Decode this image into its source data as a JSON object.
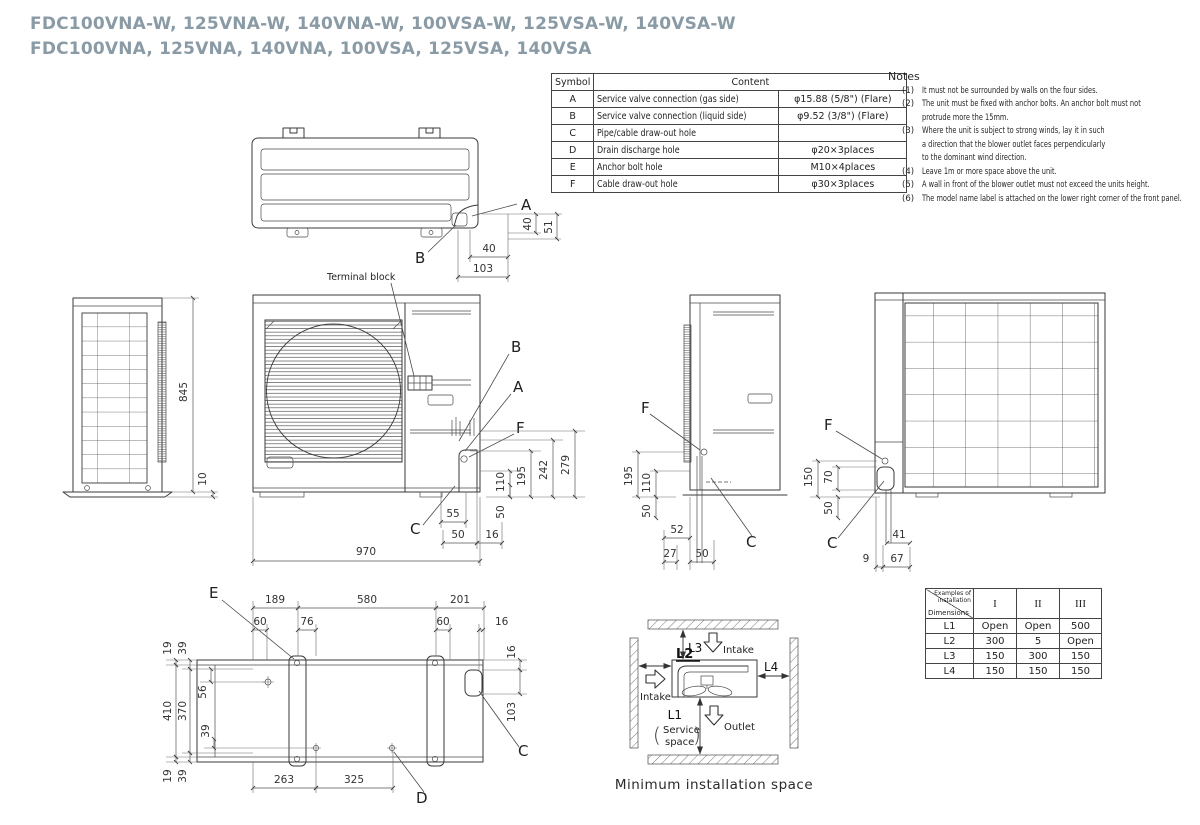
{
  "title": {
    "line1": "FDC100VNA-W, 125VNA-W, 140VNA-W, 100VSA-W, 125VSA-W, 140VSA-W",
    "line2": "FDC100VNA, 125VNA, 140VNA, 100VSA, 125VSA, 140VSA"
  },
  "symbol_table": {
    "col_symbol": "Symbol",
    "col_content": "Content",
    "rows": [
      {
        "symbol": "A",
        "content": "Service valve connection (gas side)",
        "spec": "φ15.88 (5/8\") (Flare)"
      },
      {
        "symbol": "B",
        "content": "Service valve connection (liquid side)",
        "spec": "φ9.52 (3/8\") (Flare)"
      },
      {
        "symbol": "C",
        "content": "Pipe/cable draw-out hole",
        "spec": ""
      },
      {
        "symbol": "D",
        "content": "Drain discharge hole",
        "spec": "φ20×3places"
      },
      {
        "symbol": "E",
        "content": "Anchor bolt hole",
        "spec": "M10×4places"
      },
      {
        "symbol": "F",
        "content": "Cable draw-out hole",
        "spec": "φ30×3places"
      }
    ]
  },
  "notes": {
    "title": "Notes",
    "items": [
      {
        "num": "(1)",
        "lines": [
          "It must not be surrounded by walls on the four sides."
        ]
      },
      {
        "num": "(2)",
        "lines": [
          "The unit must be fixed with anchor bolts. An anchor bolt must not",
          "protrude more the 15mm."
        ]
      },
      {
        "num": "(3)",
        "lines": [
          "Where the unit is subject to strong winds, lay it in such",
          "a direction that the blower outlet faces perpendicularly",
          "to the dominant wind direction."
        ]
      },
      {
        "num": "(4)",
        "lines": [
          "Leave 1m or more space above the unit."
        ]
      },
      {
        "num": "(5)",
        "lines": [
          "A wall in front of the blower outlet must not exceed the units height."
        ]
      },
      {
        "num": "(6)",
        "lines": [
          "The model name label is attached on the lower right corner of the front panel."
        ]
      }
    ]
  },
  "views": {
    "top": {
      "label_a": "A",
      "label_b": "B",
      "dim_w1": "40",
      "dim_w2": "103",
      "dim_h1": "40",
      "dim_h2": "51"
    },
    "side_left": {
      "dim_height": "845",
      "dim_base": "10"
    },
    "front": {
      "terminal_block": "Terminal block",
      "label_b": "B",
      "label_a": "A",
      "label_f": "F",
      "label_c": "C",
      "dim_v1": "110",
      "dim_v2": "195",
      "dim_v3": "242",
      "dim_v4": "279",
      "dim_v5": "50",
      "dim_b1": "55",
      "dim_b2": "50",
      "dim_b3": "16",
      "dim_width": "970"
    },
    "side_right": {
      "label_f": "F",
      "label_c": "C",
      "dim_v1": "195",
      "dim_v2": "110",
      "dim_v3": "50",
      "dim_b1": "52",
      "dim_b2": "27",
      "dim_b3": "50"
    },
    "rear": {
      "label_f": "F",
      "label_c": "C",
      "dim_v1": "150",
      "dim_v2": "70",
      "dim_v3": "50",
      "dim_b1": "41",
      "dim_b2": "9",
      "dim_b3": "67"
    },
    "bottom": {
      "label_e": "E",
      "label_d": "D",
      "label_c": "C",
      "dim_t1": "189",
      "dim_t2": "580",
      "dim_t3": "201",
      "dim_t4": "60",
      "dim_t5": "76",
      "dim_t6": "60",
      "dim_t7": "16",
      "dim_l1": "19",
      "dim_l2": "39",
      "dim_l3": "410",
      "dim_l4": "370",
      "dim_l5": "56",
      "dim_l6": "39",
      "dim_l7": "19",
      "dim_l8": "39",
      "dim_r1": "16",
      "dim_r2": "103",
      "dim_b1": "263",
      "dim_b2": "325"
    }
  },
  "install_space": {
    "labels": {
      "l1": "L1",
      "l2": "L2",
      "l3": "L3",
      "l4": "L4"
    },
    "intake_top": "Intake",
    "intake_left": "Intake",
    "outlet": "Outlet",
    "service_line1": "Service",
    "service_line2": "space",
    "paren_open": "(",
    "paren_close": ")",
    "caption": "Minimum installation space"
  },
  "install_table": {
    "corner_top": "Examples of",
    "corner_top2": "installation",
    "corner_bottom": "Dimensions",
    "cols": [
      "I",
      "II",
      "III"
    ],
    "rows": [
      {
        "label": "L1",
        "values": [
          "Open",
          "Open",
          "500"
        ]
      },
      {
        "label": "L2",
        "values": [
          "300",
          "5",
          "Open"
        ]
      },
      {
        "label": "L3",
        "values": [
          "150",
          "300",
          "150"
        ]
      },
      {
        "label": "L4",
        "values": [
          "150",
          "150",
          "150"
        ]
      }
    ]
  }
}
